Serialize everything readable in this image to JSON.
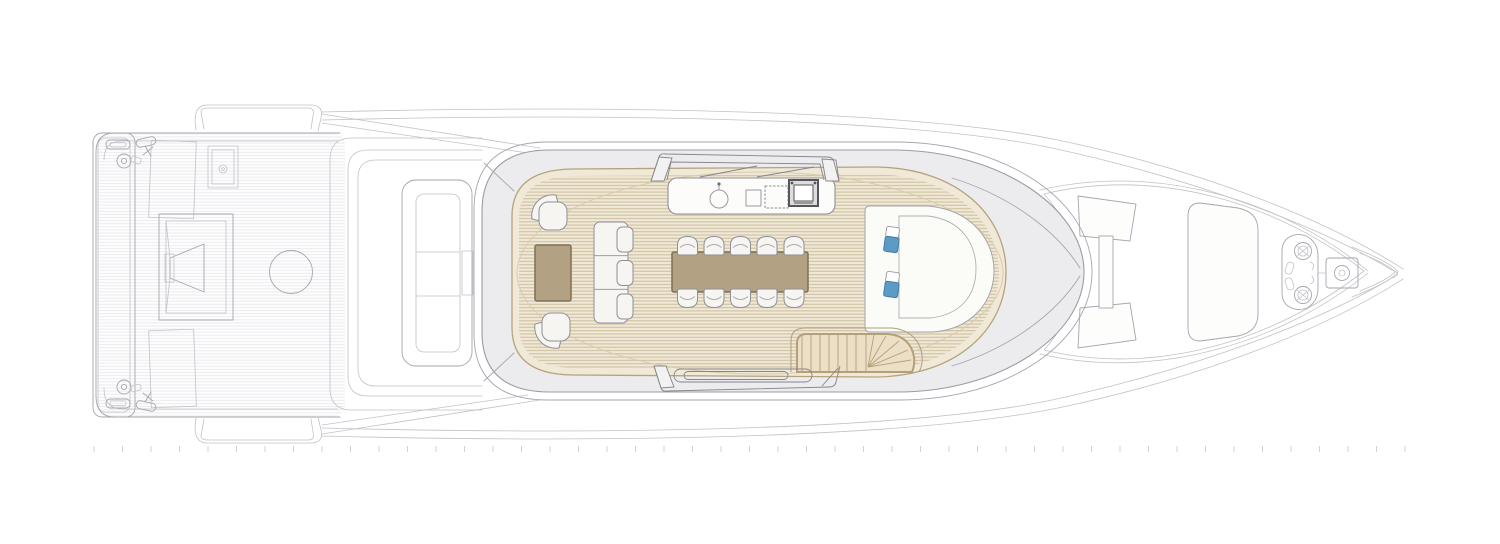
{
  "meta": {
    "title": "Motor yacht sun-deck floor plan, top view",
    "view": "plan"
  },
  "colors": {
    "background": "#ffffff",
    "line_light": "#c2c2c8",
    "line_mid": "#9a9aa1",
    "superstructure_fill": "#ececee",
    "superstructure_stroke": "#9c9ca3",
    "teak_base": "#f0e9d7",
    "teak_stripe": "#cfc0a0",
    "teak_edge": "#b5a37d",
    "table_brown": "#b3a184",
    "table_stroke": "#7e7055",
    "furniture_fill": "#f6f5f1",
    "furniture_stroke": "#8f8f98",
    "console_fill": "#fbfbf8",
    "seat_blue": "#5b9bc4",
    "seat_blue_stroke": "#3f7ea6",
    "stair_fill": "#ecdfc5",
    "stair_line": "#b2a07a",
    "grill_dark": "#55555a",
    "ruler_tick": "#d0d0d5"
  },
  "labels": {
    "stern": "Stern with swim platform and aft deck",
    "swim_platform": "Swim platform",
    "aft_stairs": "Aft side stairs",
    "aft_table": "Aft deck table",
    "round_table": "Round table",
    "main_sofa": "Main deck aft sofa",
    "sun_deck": "Sun deck with teak flooring",
    "wet_bar": "Wet bar with sink and grill",
    "dining_table": "Dining table",
    "dining_chairs": "Dining chairs",
    "lounge_sofa": "Three-seat bench sofa",
    "coffee_table": "Coffee table",
    "armchairs": "Lounge armchairs",
    "helm": "Helm station with two seats",
    "staircase": "Staircase to lower deck",
    "foredeck": "Foredeck",
    "bow_sunpad": "Bow sun pad",
    "windlass": "Anchor windlass pod",
    "ruler": "Scale ruler"
  },
  "counts": {
    "dining_chairs": 10,
    "helm_seats": 2,
    "sofa_sections": 3,
    "lounge_armchairs": 2,
    "stair_treads": 8
  },
  "ruler": {
    "tick_count": 47,
    "start_x": 94,
    "spacing": 28.5,
    "y1": 446,
    "y2": 452
  }
}
